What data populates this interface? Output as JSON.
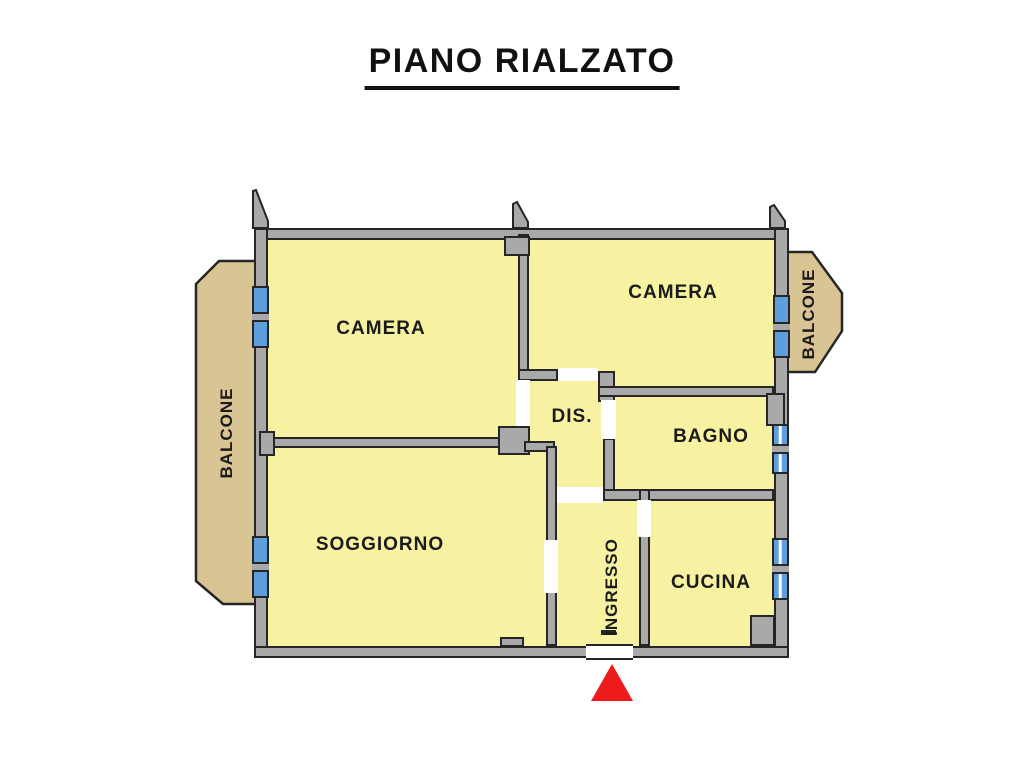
{
  "title": "PIANO RIALZATO",
  "floor_plan": {
    "rooms": [
      {
        "id": "camera-left",
        "label": "CAMERA"
      },
      {
        "id": "camera-right",
        "label": "CAMERA"
      },
      {
        "id": "disimpegno",
        "label": "DIS."
      },
      {
        "id": "bagno",
        "label": "BAGNO"
      },
      {
        "id": "soggiorno",
        "label": "SOGGIORNO"
      },
      {
        "id": "ingresso",
        "label": "INGRESSO"
      },
      {
        "id": "cucina",
        "label": "CUCINA"
      }
    ],
    "balconies": [
      {
        "id": "balcone-left",
        "label": "BALCONE"
      },
      {
        "id": "balcone-right",
        "label": "BALCONE"
      }
    ],
    "entrance_marker": "red-triangle-arrow"
  },
  "colors": {
    "wall": "#a9a9a9",
    "outline": "#262626",
    "room_fill": "#f7f1a2",
    "balcony_fill": "#d9c494",
    "window_blue": "#5f9edd",
    "marker_red": "#ee1b1b",
    "label_text": "#1b1b1b"
  }
}
